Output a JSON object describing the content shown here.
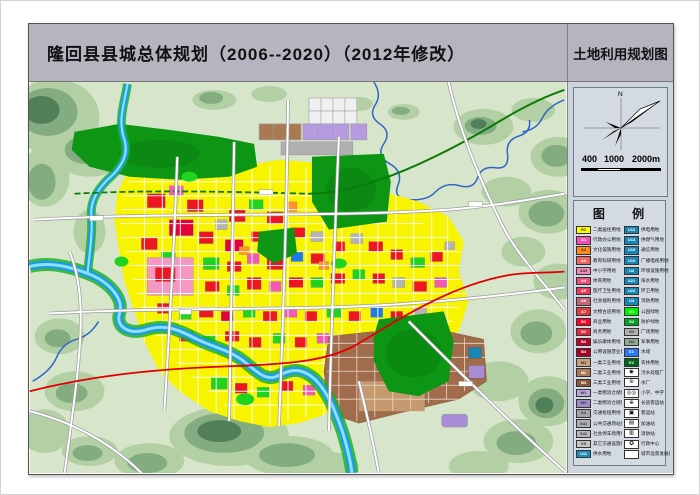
{
  "page": {
    "main_title": "隆回县县城总体规划（2006--2020）（2012年修改）",
    "map_type_title": "土地利用规划图"
  },
  "compass": {
    "north_label": "N"
  },
  "scale_bar": {
    "labels": [
      "400",
      "1000",
      "2000m"
    ]
  },
  "legend": {
    "title": "图 例",
    "left_column": [
      {
        "code": "R2",
        "label": "二类居住用地",
        "color": "#ffff00"
      },
      {
        "code": "A1",
        "label": "行政办公用地",
        "color": "#f050b4"
      },
      {
        "code": "A2",
        "label": "文化设施用地",
        "color": "#ff8c1a"
      },
      {
        "code": "A3",
        "label": "教育科研用地",
        "color": "#f06464"
      },
      {
        "code": "A33",
        "label": "中小学用地",
        "color": "#f08cb4"
      },
      {
        "code": "A4",
        "label": "体育用地",
        "color": "#e85078"
      },
      {
        "code": "A5",
        "label": "医疗卫生用地",
        "color": "#e83c5a"
      },
      {
        "code": "A6",
        "label": "社会福利用地",
        "color": "#c86478"
      },
      {
        "code": "A7",
        "label": "文物古迹用地",
        "color": "#d84040"
      },
      {
        "code": "B1",
        "label": "商业用地",
        "color": "#ff0028"
      },
      {
        "code": "B2",
        "label": "商务用地",
        "color": "#e8283c"
      },
      {
        "code": "B3",
        "label": "娱乐康体用地",
        "color": "#c00028"
      },
      {
        "code": "B4",
        "label": "公用设施营业网点用地",
        "color": "#a80020"
      },
      {
        "code": "M1",
        "label": "一类工业用地",
        "color": "#c8a080"
      },
      {
        "code": "M2",
        "label": "二类工业用地",
        "color": "#a87858"
      },
      {
        "code": "M3",
        "label": "三类工业用地",
        "color": "#885838"
      },
      {
        "code": "W1",
        "label": "一类物流仓储用地",
        "color": "#b8a8dc"
      },
      {
        "code": "W2",
        "label": "二类物流仓储用地",
        "color": "#9c8cc8"
      },
      {
        "code": "S3",
        "label": "交通枢纽用地",
        "color": "#a4a4a4"
      },
      {
        "code": "S41",
        "label": "公共交通场站用地",
        "color": "#b0b0b0"
      },
      {
        "code": "S42",
        "label": "社会停车场用地",
        "color": "#b8b8b8"
      },
      {
        "code": "S9",
        "label": "其它交通设施用地",
        "color": "#c4c4c4"
      },
      {
        "code": "U11",
        "label": "供水用地",
        "color": "#1890b8"
      }
    ],
    "right_column": [
      {
        "code": "U12",
        "label": "供电用地",
        "color": "#1886b4"
      },
      {
        "code": "U13",
        "label": "供燃气用地",
        "color": "#1886b4"
      },
      {
        "code": "U15",
        "label": "通信用地",
        "color": "#1886b4"
      },
      {
        "code": "U16",
        "label": "广播电视用地",
        "color": "#1886b4"
      },
      {
        "code": "U2",
        "label": "环境设施用地",
        "color": "#1886b4"
      },
      {
        "code": "U21",
        "label": "排水用地",
        "color": "#1886b4"
      },
      {
        "code": "U22",
        "label": "环卫用地",
        "color": "#1886b4"
      },
      {
        "code": "U3",
        "label": "消防用地",
        "color": "#1886b4"
      },
      {
        "code": "G1",
        "label": "公园绿地",
        "color": "#00f000"
      },
      {
        "code": "G2",
        "label": "防护绿地",
        "color": "#00a020"
      },
      {
        "code": "G3",
        "label": "广场用地",
        "color": "#b0b0b0"
      },
      {
        "code": "H4",
        "label": "军事用地",
        "color": "#90a890"
      },
      {
        "code": "E1",
        "label": "水域",
        "color": "#2878f8"
      },
      {
        "code": "E2",
        "label": "农林用地",
        "color": "#006418"
      },
      {
        "type": "icon",
        "glyph": "◉",
        "icon_name": "sewage-plant-icon",
        "label": "污水处理厂"
      },
      {
        "type": "icon",
        "glyph": "⊛",
        "icon_name": "water-plant-icon",
        "label": "水厂"
      },
      {
        "type": "icon",
        "glyph": "◎◎",
        "icon_name": "school-icon",
        "label": "小学、中学"
      },
      {
        "type": "icon",
        "glyph": "⊕",
        "icon_name": "coach-station-icon",
        "label": "长途客运站"
      },
      {
        "type": "icon",
        "glyph": "▣",
        "icon_name": "passenger-station-icon",
        "label": "客运站"
      },
      {
        "type": "icon",
        "glyph": "▤",
        "icon_name": "gas-station-icon",
        "label": "加油站"
      },
      {
        "type": "icon",
        "glyph": "▥",
        "icon_name": "fire-station-icon",
        "label": "消防站"
      },
      {
        "type": "icon",
        "glyph": "✪",
        "icon_name": "admin-center-icon",
        "label": "行政中心"
      },
      {
        "type": "blank",
        "label": "城市远景发展用地"
      }
    ]
  },
  "map": {
    "colors": {
      "countryside": "#d7e5cb",
      "hills_light": "#b2cfa4",
      "hills_mid": "#7fab7c",
      "hills_dark": "#4a7b52",
      "residential_yellow": "#f8f400",
      "park_green": "#0c9614",
      "bright_green": "#1ed41e",
      "water_blue": "#1e9ce0",
      "industrial_brown": "#a06c4c",
      "highway_red": "#e00000",
      "railway_green": "#0a7a0a",
      "road_white": "#ffffff"
    }
  }
}
